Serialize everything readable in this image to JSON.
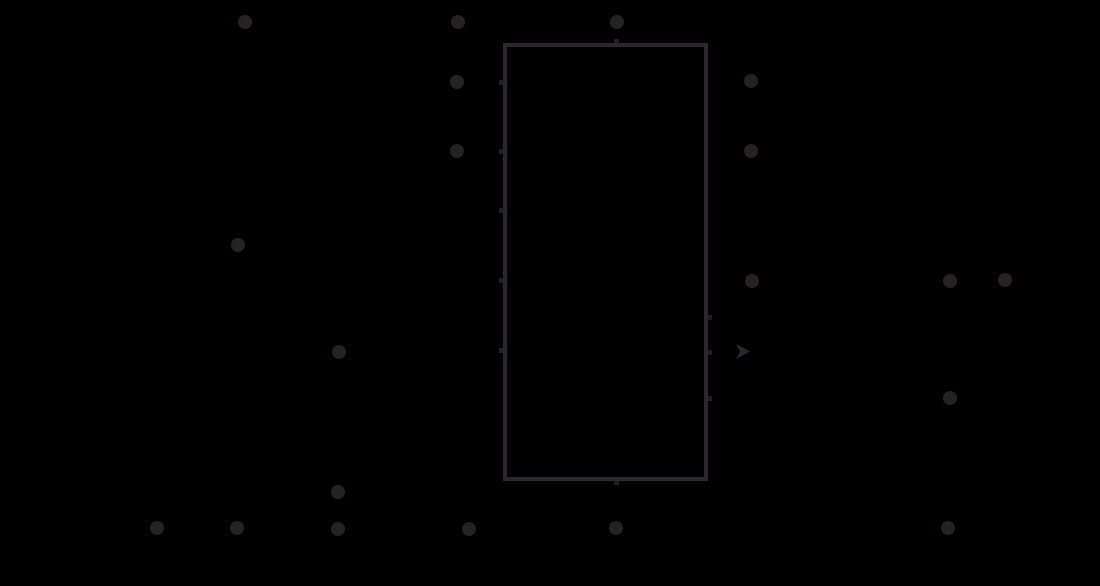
{
  "meta": {
    "canvas_width": 1100,
    "canvas_height": 586,
    "background_color": "#000000",
    "dot_color": "#262223",
    "line_color": "#2b272a",
    "stub_color": "#211e20",
    "arrow_color": "#2b2730"
  },
  "diagram": {
    "dot_radius": 7,
    "dots": [
      {
        "x": 245,
        "y": 22
      },
      {
        "x": 458,
        "y": 22
      },
      {
        "x": 617,
        "y": 22
      },
      {
        "x": 457,
        "y": 82
      },
      {
        "x": 751,
        "y": 81
      },
      {
        "x": 457,
        "y": 151
      },
      {
        "x": 751,
        "y": 151
      },
      {
        "x": 238,
        "y": 245
      },
      {
        "x": 752,
        "y": 281
      },
      {
        "x": 950,
        "y": 281
      },
      {
        "x": 1005,
        "y": 280
      },
      {
        "x": 339,
        "y": 352
      },
      {
        "x": 950,
        "y": 398
      },
      {
        "x": 338,
        "y": 492
      },
      {
        "x": 157,
        "y": 528
      },
      {
        "x": 237,
        "y": 528
      },
      {
        "x": 338,
        "y": 529
      },
      {
        "x": 469,
        "y": 529
      },
      {
        "x": 616,
        "y": 528
      },
      {
        "x": 948,
        "y": 528
      }
    ],
    "rectangle": {
      "left": 503,
      "top": 43,
      "width": 205,
      "height": 438,
      "stroke_width": 4
    },
    "stubs": [
      {
        "x": 499,
        "y": 80,
        "w": 4,
        "h": 5
      },
      {
        "x": 499,
        "y": 149,
        "w": 4,
        "h": 5
      },
      {
        "x": 499,
        "y": 208,
        "w": 4,
        "h": 5
      },
      {
        "x": 499,
        "y": 278,
        "w": 4,
        "h": 5
      },
      {
        "x": 499,
        "y": 348,
        "w": 4,
        "h": 5
      },
      {
        "x": 708,
        "y": 315,
        "w": 4,
        "h": 5
      },
      {
        "x": 708,
        "y": 350,
        "w": 4,
        "h": 5
      },
      {
        "x": 708,
        "y": 396,
        "w": 4,
        "h": 5
      },
      {
        "x": 614,
        "y": 39,
        "w": 5,
        "h": 4
      },
      {
        "x": 614,
        "y": 481,
        "w": 5,
        "h": 4
      }
    ],
    "arrowhead": {
      "x": 736,
      "y": 344,
      "width": 14,
      "height": 15
    }
  }
}
